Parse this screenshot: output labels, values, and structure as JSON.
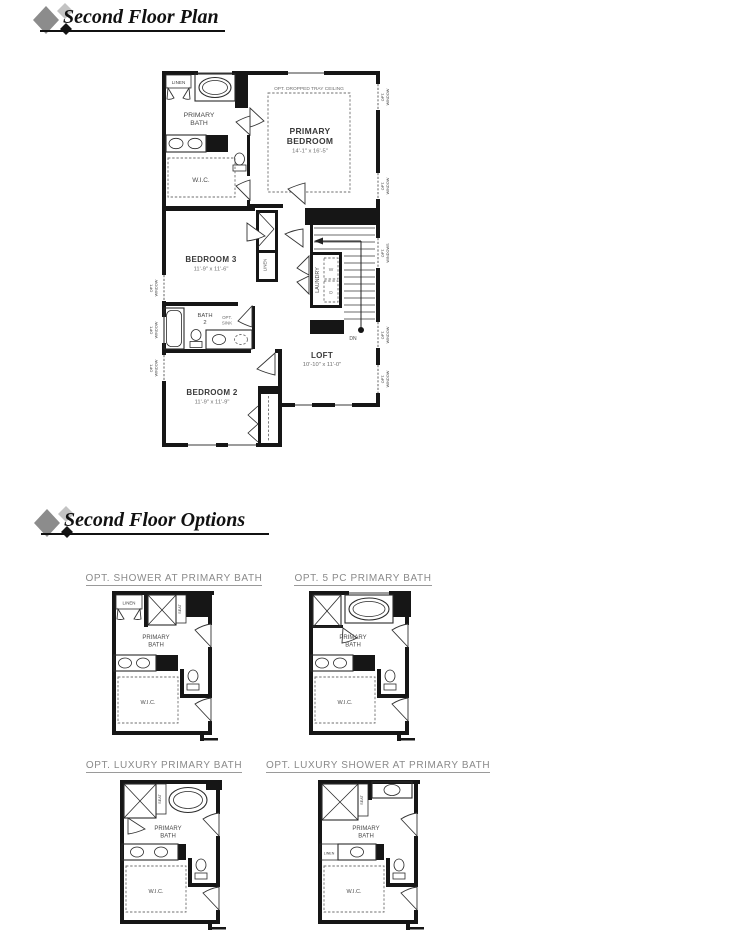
{
  "headers": {
    "plan": "Second Floor Plan",
    "options": "Second Floor Options"
  },
  "main_plan": {
    "linen": "LINEN",
    "primary_bath_1": "PRIMARY",
    "primary_bath_2": "BATH",
    "wic": "W.I.C.",
    "tray": "OPT. DROPPED TRAY CEILING",
    "primary_bedroom_1": "PRIMARY",
    "primary_bedroom_2": "BEDROOM",
    "primary_bedroom_dims": "14'-1\" x 16'-5\"",
    "bedroom3": "BEDROOM 3",
    "bedroom3_dims": "11'-9\" x 11'-6\"",
    "hall_linen": "LINEN",
    "laundry": "LAUNDRY",
    "washer": "W",
    "dryer": "D",
    "down": "DN",
    "bath2_1": "BATH",
    "bath2_2": "2",
    "opt_sink_1": "OPT.",
    "opt_sink_2": "SINK",
    "bedroom2": "BEDROOM 2",
    "bedroom2_dims": "11'-9\" x 11'-9\"",
    "loft": "LOFT",
    "loft_dims": "10'-10\" x 11'-0\"",
    "opt_window_1": "OPT.",
    "opt_window_2": "WINDOW",
    "opt_windows_1": "OPT.",
    "opt_windows_2": "WINDOWS"
  },
  "options": {
    "opt1": {
      "title": "OPT. SHOWER AT PRIMARY BATH",
      "linen": "LINEN",
      "seat": "SEAT",
      "bath_1": "PRIMARY",
      "bath_2": "BATH",
      "wic": "W.I.C."
    },
    "opt2": {
      "title": "OPT. 5 PC PRIMARY BATH",
      "bath_1": "PRIMARY",
      "bath_2": "BATH",
      "wic": "W.I.C."
    },
    "opt3": {
      "title": "OPT. LUXURY PRIMARY BATH",
      "seat": "SEAT",
      "bath_1": "PRIMARY",
      "bath_2": "BATH",
      "wic": "W.I.C."
    },
    "opt4": {
      "title": "OPT. LUXURY SHOWER AT PRIMARY BATH",
      "seat": "SEAT",
      "linen": "LINEN",
      "bath_1": "PRIMARY",
      "bath_2": "BATH",
      "wic": "W.I.C."
    }
  },
  "colors": {
    "wall": "#161616",
    "option_title": "#8a8a8a",
    "diamond_gray": "#8c8c8c",
    "diamond_light": "#c3c3c3",
    "diamond_black": "#141414"
  }
}
